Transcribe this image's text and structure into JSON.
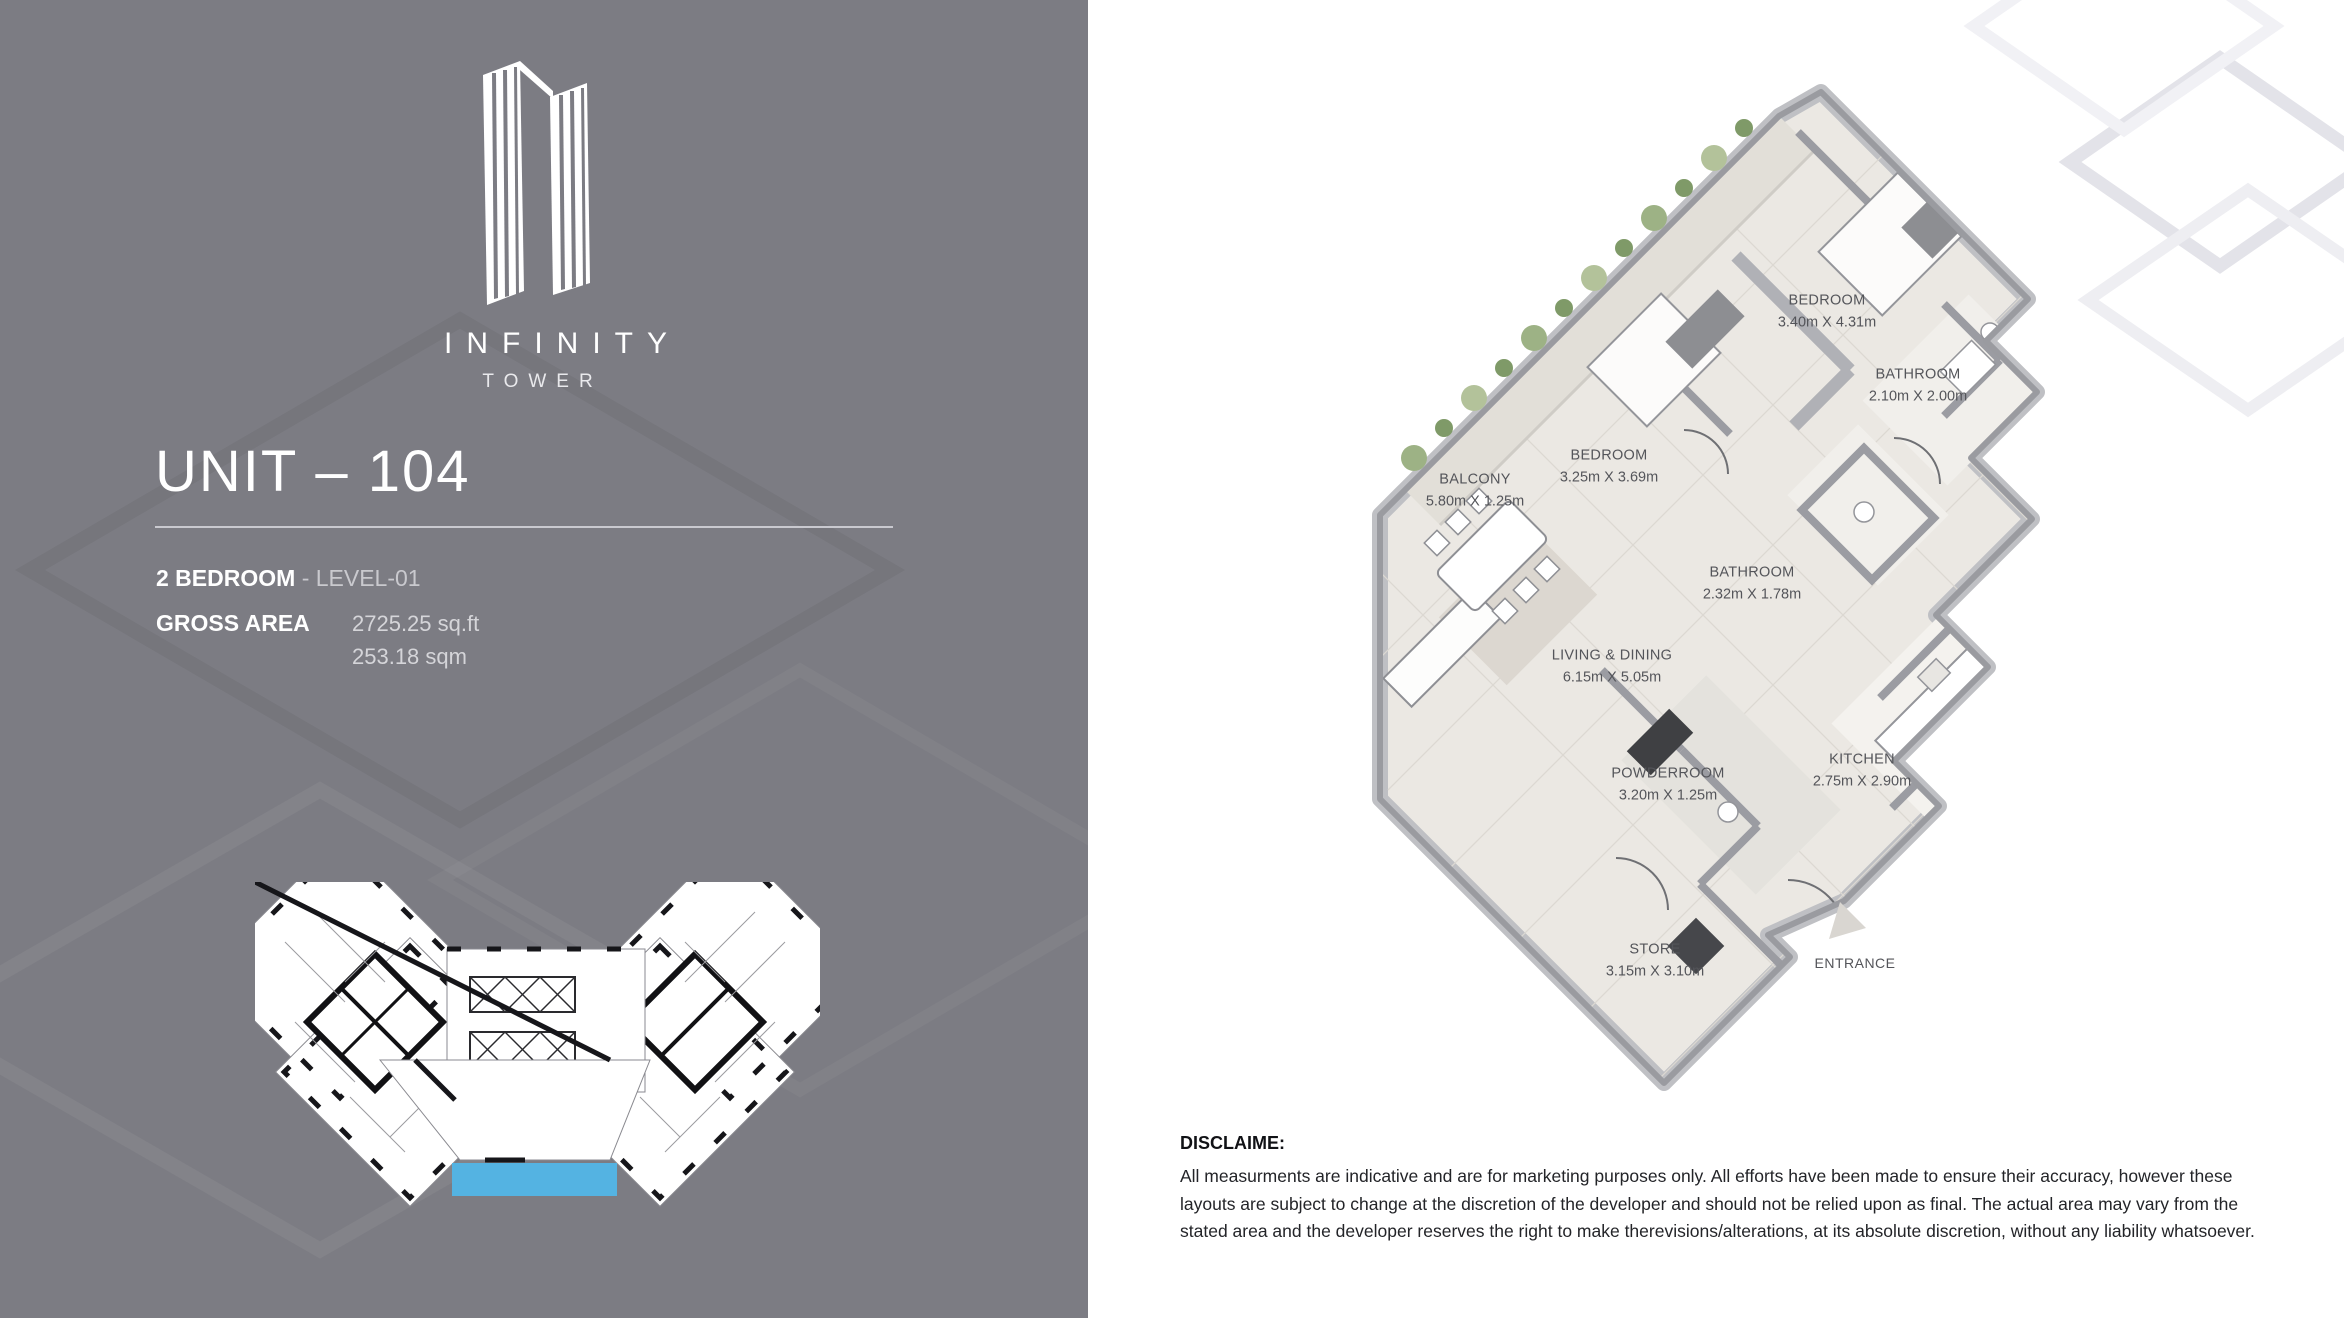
{
  "brand": {
    "name": "INFINITY",
    "tagline": "TOWER"
  },
  "unit": {
    "title": "UNIT – 104",
    "bedrooms": "2 BEDROOM",
    "level": "- LEVEL-01",
    "gross_area_label": "GROSS AREA",
    "area_sqft": "2725.25 sq.ft",
    "area_sqm": "253.18 sqm"
  },
  "floorplan": {
    "rooms": [
      {
        "name": "BEDROOM",
        "dims": "3.40m X 4.31m"
      },
      {
        "name": "BATHROOM",
        "dims": "2.10m X 2.00m"
      },
      {
        "name": "BEDROOM",
        "dims": "3.25m X 3.69m"
      },
      {
        "name": "BALCONY",
        "dims": "5.80m X 1.25m"
      },
      {
        "name": "BATHROOM",
        "dims": "2.32m X 1.78m"
      },
      {
        "name": "LIVING & DINING",
        "dims": "6.15m X 5.05m"
      },
      {
        "name": "KITCHEN",
        "dims": "2.75m X 2.90m"
      },
      {
        "name": "POWDERROOM",
        "dims": "3.20m X 1.25m"
      },
      {
        "name": "STORE",
        "dims": "3.15m X 3.10m"
      }
    ],
    "entrance_label": "ENTRANCE"
  },
  "disclaimer": {
    "heading": "DISCLAIME:",
    "body": "All measurments are indicative and are for marketing purposes only. All efforts have been made to ensure their accuracy, however these layouts are subject to change at the discretion of the developer and should not be relied upon as final. The actual area may vary from the stated area and the developer reserves the right to make therevisions/alterations, at its absolute discretion, without any liability whatsoever."
  },
  "colors": {
    "panel_gray": "#7c7c83",
    "highlight_blue": "#54b3e2",
    "glass_teal": "#8fc2c6",
    "wall_gray": "#9a9ba0"
  }
}
